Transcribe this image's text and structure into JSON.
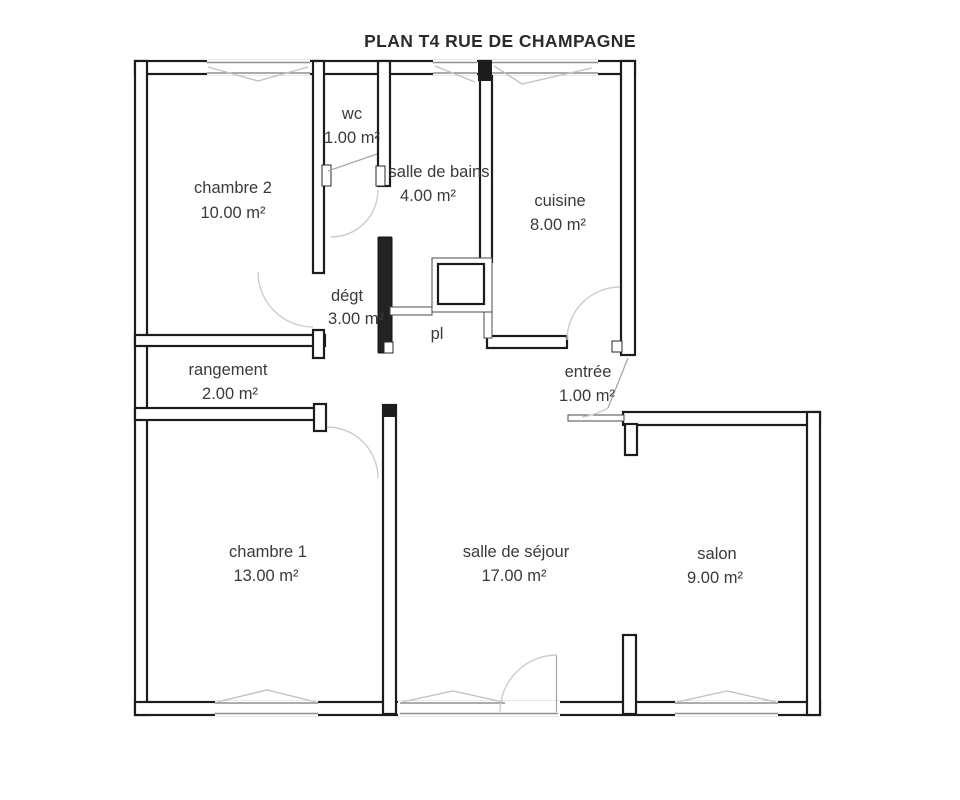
{
  "title": "PLAN T4 RUE DE CHAMPAGNE",
  "rooms": [
    {
      "name": "chambre 2",
      "area": "10.00 m²"
    },
    {
      "name": "wc",
      "area": "1.00 m²"
    },
    {
      "name": "salle de bains",
      "area": "4.00 m²"
    },
    {
      "name": "cuisine",
      "area": "8.00 m²"
    },
    {
      "name": "dégt",
      "area": "3.00 m²"
    },
    {
      "name": "pl",
      "area": ""
    },
    {
      "name": "rangement",
      "area": "2.00 m²"
    },
    {
      "name": "entrée",
      "area": "1.00 m²"
    },
    {
      "name": "chambre 1",
      "area": "13.00 m²"
    },
    {
      "name": "salle de séjour",
      "area": "17.00 m²"
    },
    {
      "name": "salon",
      "area": "9.00 m²"
    }
  ],
  "colors": {
    "wall": "#1c1c1c",
    "window_line": "#8f8f8f",
    "door_arc": "#cccccc",
    "text": "#3a3a3a",
    "background": "#ffffff"
  }
}
